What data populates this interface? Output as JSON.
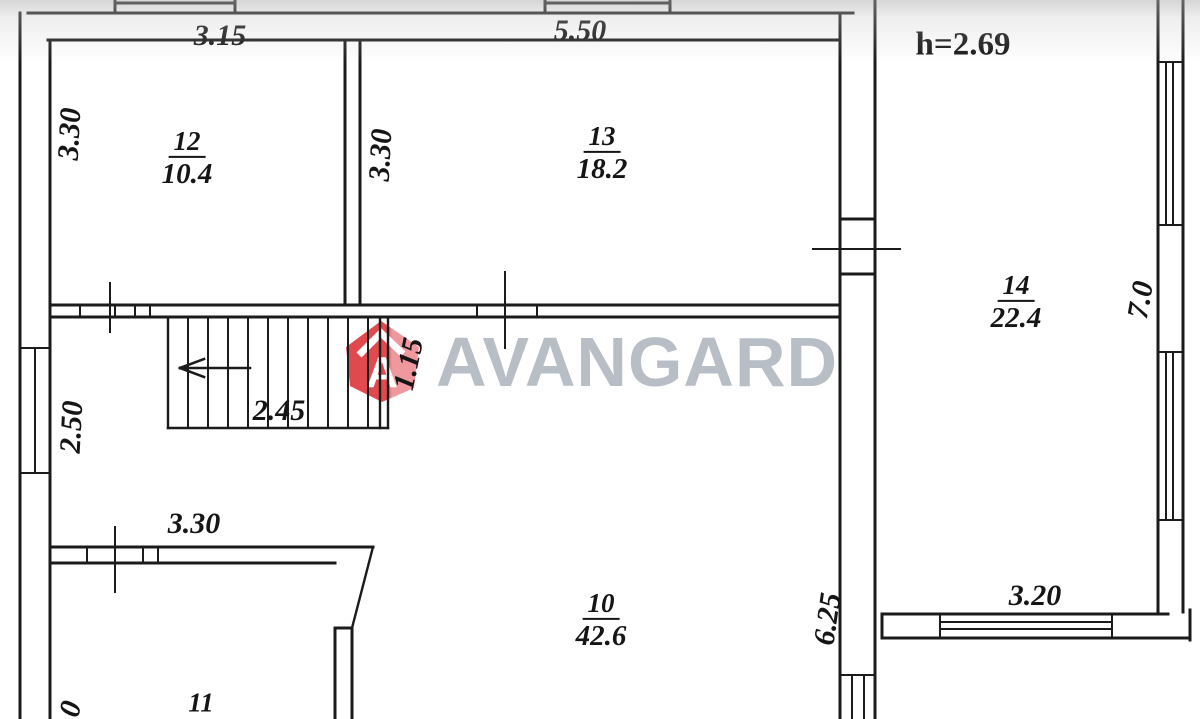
{
  "colors": {
    "line": "#1b1b1b",
    "logo_red": "#df4046",
    "logo_red_light": "#ee9298",
    "watermark_gray": "#b7bec6",
    "background": "#ffffff"
  },
  "watermark": {
    "brand": "AVANGARD",
    "logo_letter": "A"
  },
  "labels": {
    "ceiling_height": "h=2.69",
    "dim_top_left": "3.15",
    "dim_top_mid": "5.50",
    "dim_room12_left": "3.30",
    "dim_room13_left": "3.30",
    "dim_hall_left": "2.50",
    "dim_stairs": "2.45",
    "dim_stairs_width": "1.15",
    "dim_room11_top": "3.30",
    "dim_room10_right": "6.25",
    "dim_room14_right": "7.0",
    "dim_room14_bottom": "3.20",
    "dim_bottom_left_partial": "0"
  },
  "rooms": {
    "room12": {
      "number": "12",
      "area": "10.4"
    },
    "room13": {
      "number": "13",
      "area": "18.2"
    },
    "room14": {
      "number": "14",
      "area": "22.4"
    },
    "room10": {
      "number": "10",
      "area": "42.6"
    },
    "room11": {
      "number": "11"
    }
  }
}
